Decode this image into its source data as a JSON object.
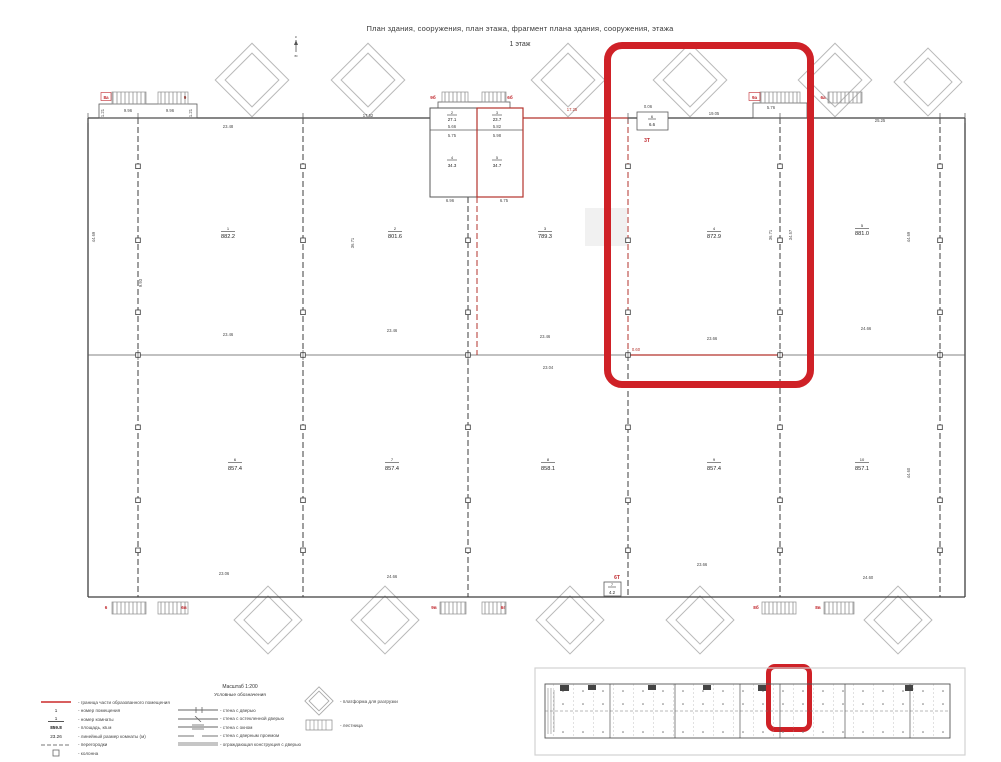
{
  "header": {
    "title": "План здания, сооружения, план этажа, фрагмент плана здания, сооружения, этажа",
    "floor": "1 этаж"
  },
  "north": {
    "n": "с",
    "s": "ю"
  },
  "plan": {
    "rooms": [
      {
        "num": "1",
        "area": "882.2"
      },
      {
        "num": "2",
        "area": "801.6"
      },
      {
        "num": "3",
        "area": "789.3"
      },
      {
        "num": "4",
        "area": "872.9"
      },
      {
        "num": "5",
        "area": "881.0"
      },
      {
        "num": "6",
        "area": "857.4"
      },
      {
        "num": "7",
        "area": "857.4"
      },
      {
        "num": "8",
        "area": "858.1"
      },
      {
        "num": "9",
        "area": "857.4"
      },
      {
        "num": "10",
        "area": "857.1"
      }
    ],
    "fragment": [
      {
        "num": "2",
        "area": "27.1"
      },
      {
        "num": "3",
        "area": "23.7"
      },
      {
        "num": "4",
        "area": "34.3"
      },
      {
        "num": "5",
        "area": "34.7"
      }
    ],
    "small": [
      {
        "num": "6",
        "area": "6.6"
      },
      {
        "num": "7",
        "area": "4.2"
      }
    ],
    "tech": [
      "3Т",
      "6Т"
    ],
    "stairs": [
      "8а",
      "9",
      "9б",
      "6б",
      "9а",
      "6а",
      "6",
      "6в",
      "9в",
      "6г",
      "8б",
      "8в"
    ],
    "dims": [
      "23.48",
      "17.52",
      "17.25",
      "19.05",
      "5.76",
      "25.25",
      "9.96",
      "9.96",
      "5.66",
      "5.82",
      "5.75",
      "5.98",
      "6.96",
      "6.75",
      "0.06",
      "23.46",
      "23.46",
      "23.46",
      "23.66",
      "24.66",
      "23.04",
      "23.06",
      "24.66",
      "23.66",
      "24.60",
      "36.71",
      "36.71",
      "34.57",
      "44.69",
      "44.60",
      "44.69",
      "9.93",
      "0.60",
      "1.21",
      "1.21"
    ]
  },
  "legend": {
    "scale": "Масштаб 1:200",
    "heading": "Условные обозначения",
    "left": [
      {
        "label": "- граница части образованного помещения"
      },
      {
        "symtext": "1",
        "label": "- номер помещения"
      },
      {
        "symtext": "1",
        "label": "- номер комнаты"
      },
      {
        "symtext": "859.8",
        "label": "- площадь, кв.м"
      },
      {
        "symtext": "23.26",
        "label": "- линейный размер комнаты (м)"
      },
      {
        "label": "- перегородки"
      },
      {
        "label": "- колонна"
      }
    ],
    "right": [
      {
        "label": "- стена с дверью"
      },
      {
        "label": "- стена с остекленной дверью"
      },
      {
        "label": "- стена с окном"
      },
      {
        "label": "- стена с дверным проемом"
      },
      {
        "label": "- ограждающая конструкция с дверью"
      }
    ],
    "extra": [
      {
        "label": "- платформа для разгрузки"
      },
      {
        "label": "- лестница"
      }
    ],
    "accent_color": "#cf2127"
  }
}
